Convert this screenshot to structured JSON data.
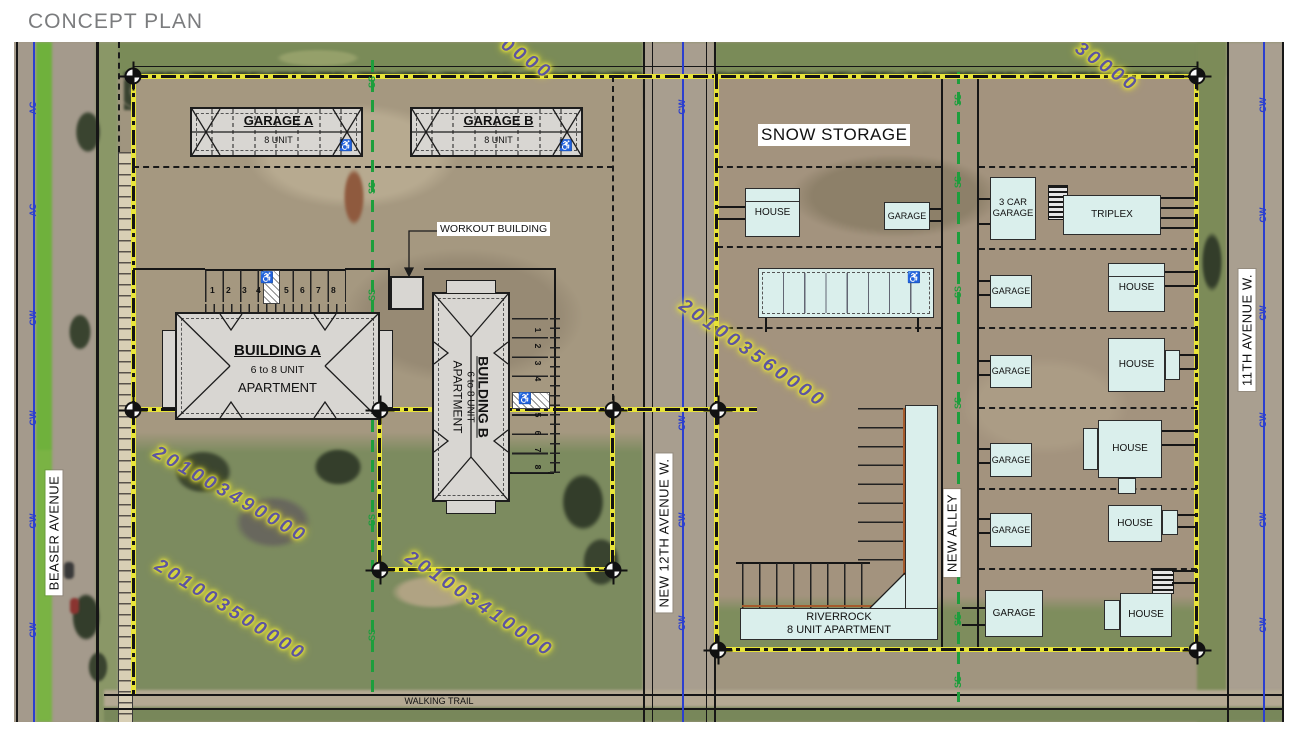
{
  "title": "CONCEPT PLAN",
  "streets": {
    "beaser_avenue": "BEASER AVENUE",
    "new_12th_avenue": "NEW 12TH AVENUE W.",
    "new_alley": "NEW ALLEY",
    "eleventh_avenue": "11TH AVENUE W.",
    "walking_trail": "WALKING TRAIL"
  },
  "utilities": {
    "sanitary_sewer": "SS",
    "city_water": "CW",
    "water_alt": "AC"
  },
  "parcel_numbers": {
    "west_north": "201003490000",
    "west_south": "201003500000",
    "west_southeast": "201003410000",
    "east_center": "201003560000",
    "top_left_partial": "0000",
    "top_right_partial": "30000"
  },
  "west_site": {
    "garage_a": {
      "name": "GARAGE A",
      "units": "8 UNIT"
    },
    "garage_b": {
      "name": "GARAGE B",
      "units": "8 UNIT"
    },
    "building_a": {
      "name": "BUILDING A",
      "units": "6 to 8 UNIT",
      "use": "APARTMENT"
    },
    "building_b": {
      "name": "BUILDING B",
      "units": "6 to 8 UNIT",
      "use": "APARTMENT"
    },
    "workout_building": "WORKOUT BUILDING",
    "stall_numbers": [
      "1",
      "2",
      "3",
      "4",
      "5",
      "6",
      "7",
      "8"
    ],
    "accessible_symbol": "♿"
  },
  "east_site": {
    "snow_storage": "SNOW STORAGE",
    "house": "HOUSE",
    "garage": "GARAGE",
    "three_car_garage": "3 CAR GARAGE",
    "eight_car_garage": "8 CAR GARAGE",
    "triplex": "TRIPLEX",
    "riverrock": {
      "name": "RIVERROCK",
      "units": "8 UNIT APARTMENT"
    }
  },
  "colors": {
    "boundary_yellow": "#e8e43a",
    "sewer_green": "#1d9e3c",
    "water_blue": "#2b3fd0",
    "parcel_number_purple": "#5d55a0",
    "proposed_building_fill": "#daefec",
    "existing_building_fill": "#d8d6d2"
  }
}
